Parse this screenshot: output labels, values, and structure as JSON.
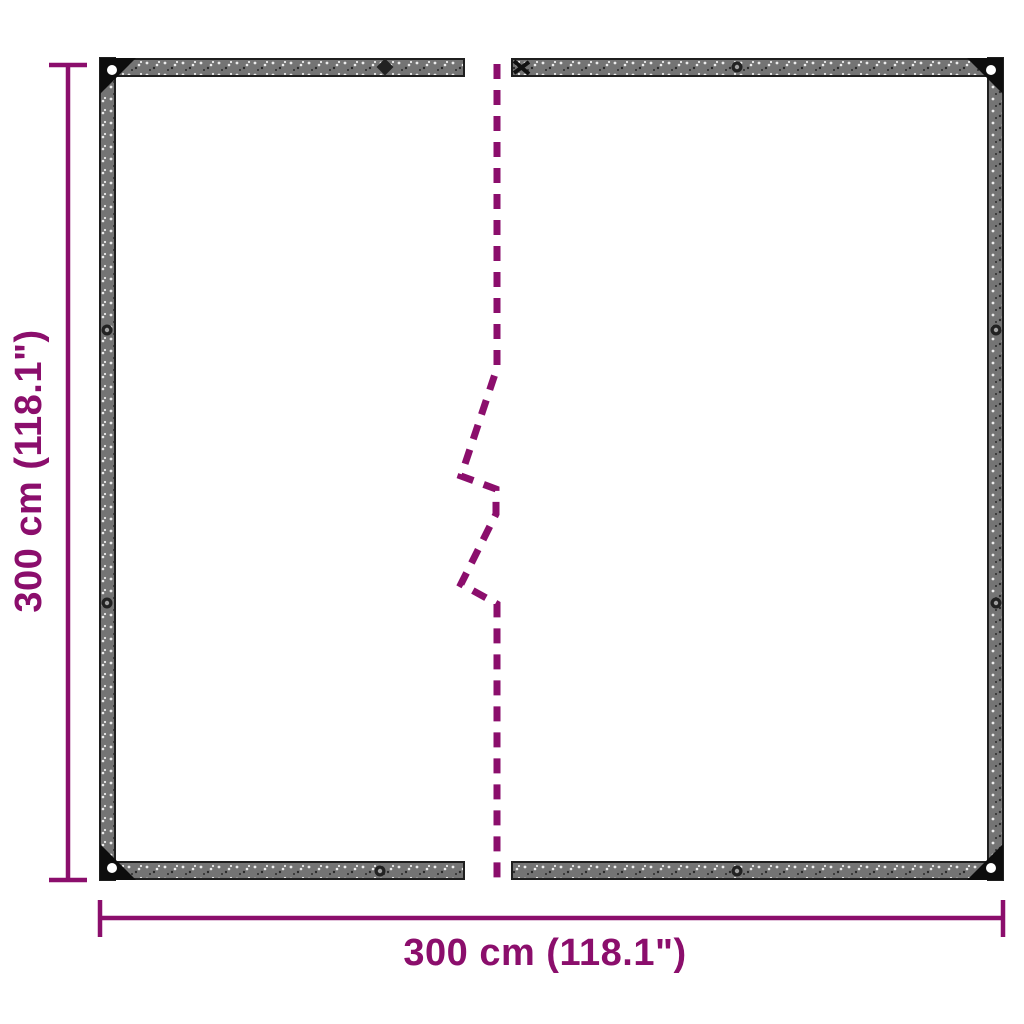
{
  "dimensions": {
    "line_color": "#8B0E6C",
    "height_label": "300 cm (118.1\")",
    "width_label": "300 cm (118.1\")"
  },
  "tarp": {
    "sheet_color": "#ffffff",
    "edge_band_color": "#747474",
    "edge_outline_color": "#1f1f1f",
    "corner_patch_color": "#0d0d0d",
    "grommet_ring_color": "#222222",
    "grommet_hole_color": "#a0a0a0",
    "speck_light": "#ececec",
    "speck_dark": "#2b2b2b"
  }
}
